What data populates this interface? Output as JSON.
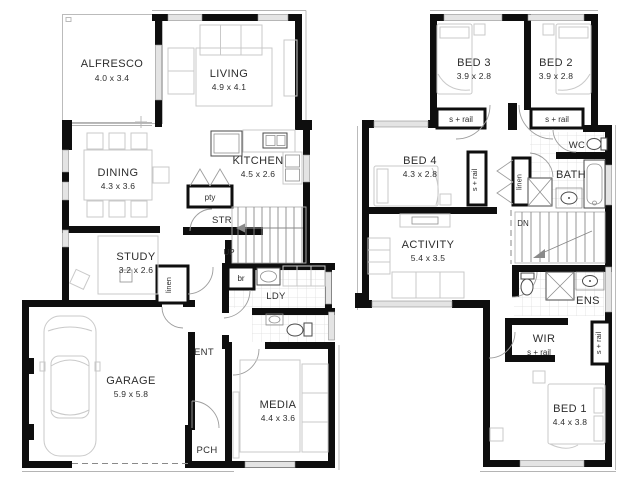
{
  "title": "Two storey house floor plan",
  "colors": {
    "wall": "#0e0e0e",
    "window": "#e4e4e4",
    "furniture": "#c9c9c9",
    "text": "#2d2d2d"
  },
  "ground_floor": {
    "rooms": [
      {
        "name": "ALFRESCO",
        "dims": "4.0 x 3.4"
      },
      {
        "name": "LIVING",
        "dims": "4.9 x 4.1"
      },
      {
        "name": "DINING",
        "dims": "4.3 x 3.6"
      },
      {
        "name": "KITCHEN",
        "dims": "4.5 x 2.6"
      },
      {
        "name": "STUDY",
        "dims": "3.2 x 2.6"
      },
      {
        "name": "GARAGE",
        "dims": "5.9 x 5.8"
      },
      {
        "name": "MEDIA",
        "dims": "4.4 x 3.6"
      }
    ],
    "labels": {
      "pantry": "pty",
      "store": "STR",
      "up": "UP",
      "broom": "br",
      "laundry": "LDY",
      "linen": "linen",
      "entry": "ENT",
      "porch": "PCH"
    }
  },
  "first_floor": {
    "rooms": [
      {
        "name": "BED 3",
        "dims": "3.9 x 2.8"
      },
      {
        "name": "BED 2",
        "dims": "3.9 x 2.8"
      },
      {
        "name": "BED 4",
        "dims": "4.3 x 2.8"
      },
      {
        "name": "ACTIVITY",
        "dims": "5.4 x 3.5"
      },
      {
        "name": "BED 1",
        "dims": "4.4 x 3.8"
      }
    ],
    "labels": {
      "srail": "s + rail",
      "wc": "WC",
      "bath": "BATH",
      "linen": "linen",
      "down": "DN",
      "ensuite": "ENS",
      "wir": "WIR"
    }
  }
}
